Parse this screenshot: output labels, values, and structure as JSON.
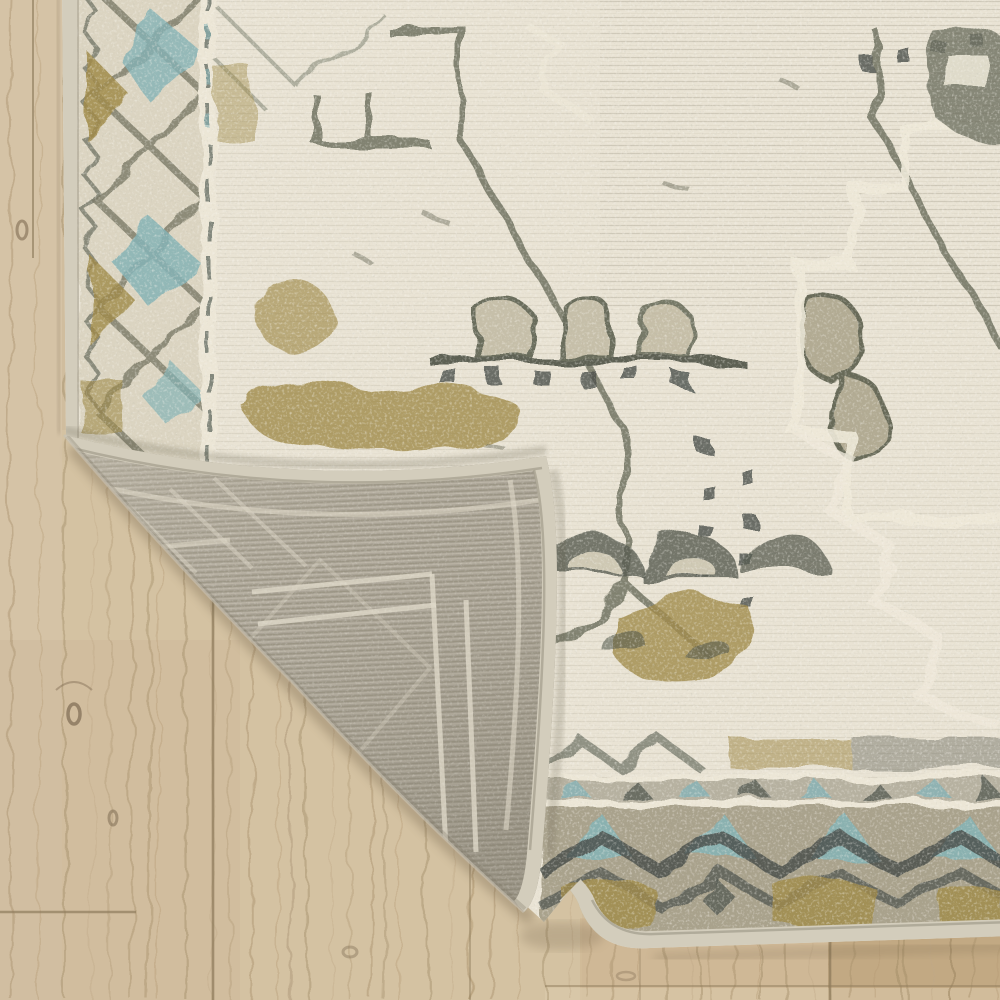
{
  "scene": {
    "type": "product-photograph",
    "subject": "Close-up of a distressed vintage-style area rug with its bottom-left corner folded over to reveal the woven rug backing, lying on a light oak wood plank floor",
    "view": "top-down close-up, no text or UI elements",
    "objects": [
      {
        "name": "wood-floor",
        "label": "light oak plank flooring, vertical planks with grain and knots"
      },
      {
        "name": "rug-front",
        "label": "rug pile face: distressed medallion pattern in ivory, beige, olive gold, gray-green and teal"
      },
      {
        "name": "rug-left-border",
        "label": "vertical border band of diamond lattice with teal and gold accents"
      },
      {
        "name": "rug-bottom-border",
        "label": "horizontal border band with white guard stripes, teal triangles and dark chevrons"
      },
      {
        "name": "folded-corner",
        "label": "triangular folded flap showing gray woven backing with ghost pattern lines"
      },
      {
        "name": "edge-binding",
        "label": "pale serged binding along rug edges"
      }
    ]
  },
  "palette": {
    "wood_base": "#d0bd9e",
    "wood_light": "#dccab0",
    "wood_grain": "#a8906c",
    "wood_seam": "#8f7c5c",
    "wood_dark": "#b89c74",
    "rug_ivory": "#e9e3d4",
    "rug_beige": "#c6bfa9",
    "rug_olive": "#6f7260",
    "rug_dark": "#4b514c",
    "rug_gold": "#a08b4a",
    "rug_teal": "#85b3b6",
    "binding": "#d3cdbc",
    "backing": "#a9a295",
    "backing_light": "#c6c0b0",
    "backing_ghost": "#ddd7c7",
    "shadow": "#5f4f38"
  }
}
